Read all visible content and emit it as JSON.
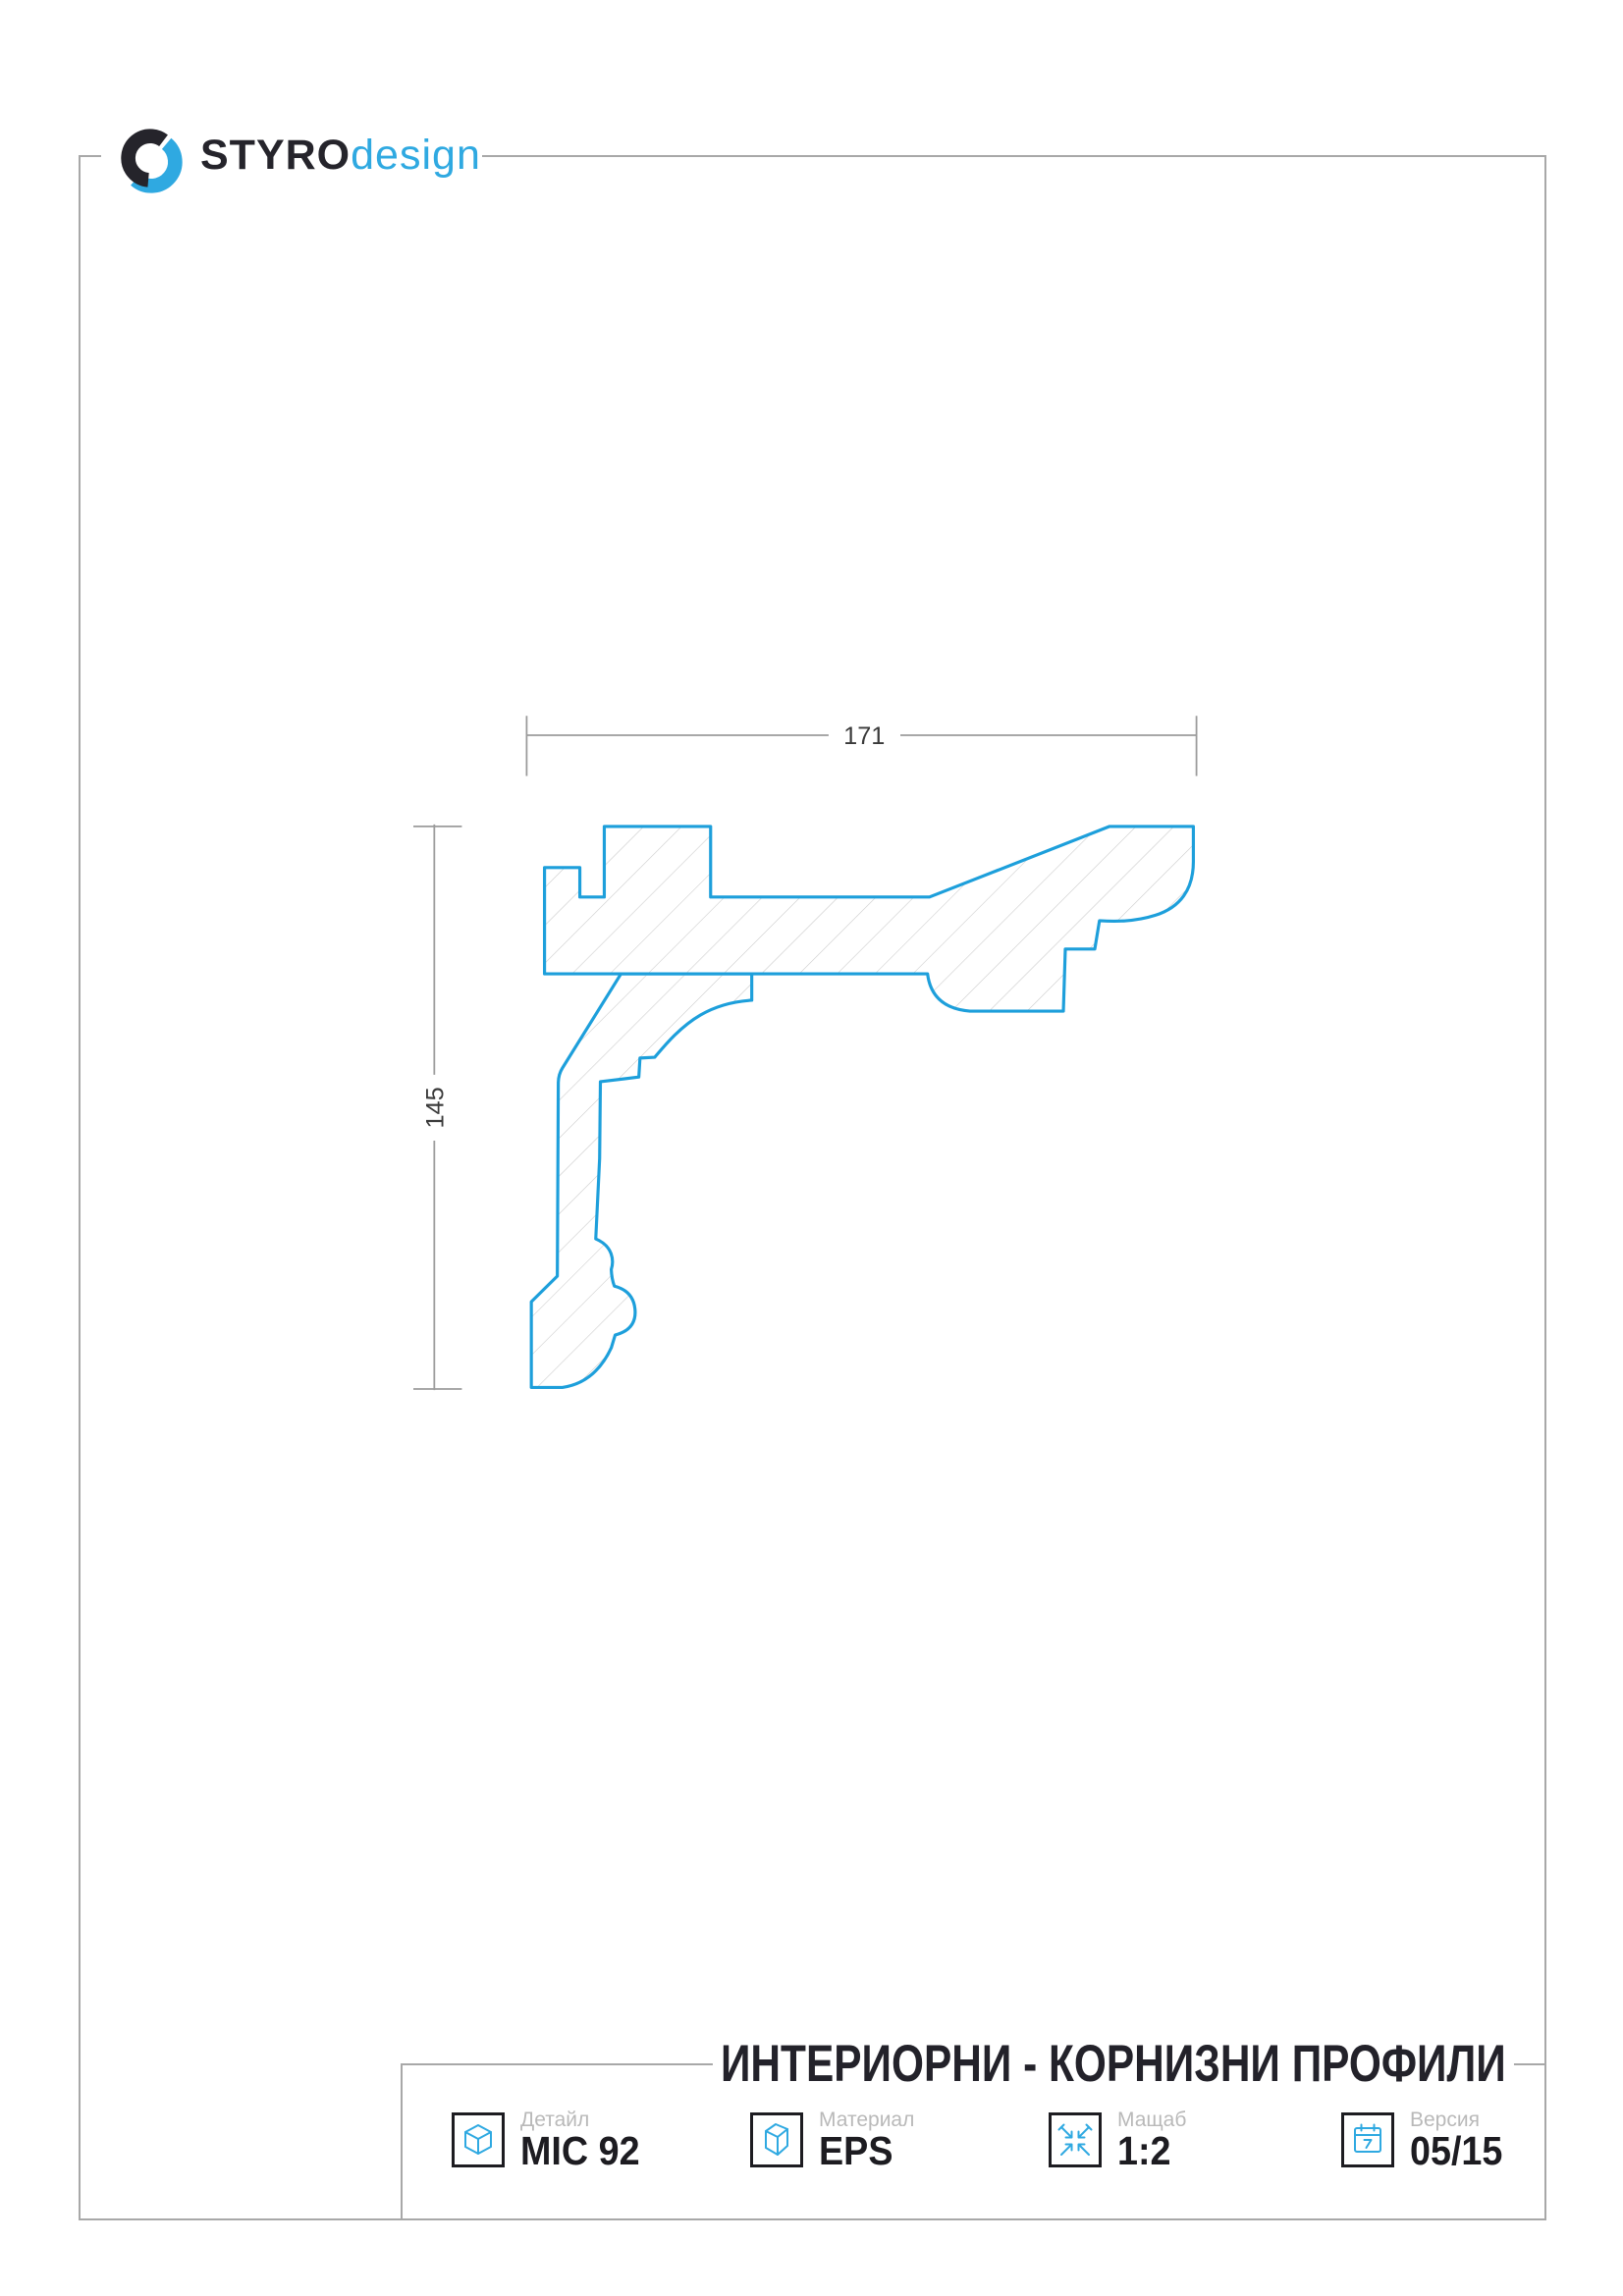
{
  "logo": {
    "brand": "STYRO",
    "brand_suffix": "design"
  },
  "drawing": {
    "width_label": "171",
    "height_label": "145"
  },
  "title_block": {
    "title": "ИНТЕРИОРНИ - КОРНИЗНИ ПРОФИЛИ",
    "cells": [
      {
        "label": "Детайл",
        "value": "MIC 92",
        "icon": "cube-icon"
      },
      {
        "label": "Материал",
        "value": "EPS",
        "icon": "material-box-icon"
      },
      {
        "label": "Мащаб",
        "value": "1:2",
        "icon": "scale-arrows-icon"
      },
      {
        "label": "Версия",
        "value": "05/15",
        "icon": "calendar-icon"
      }
    ]
  },
  "colors": {
    "outline_blue": "#1d9fdb",
    "logo_blue": "#2fa9e1",
    "logo_dark": "#25242b",
    "frame_gray": "#a8a8a8",
    "dim_gray": "#9b9b9b",
    "hatch_gray": "#c9c9c9",
    "text_dark": "#1d1c21",
    "label_gray": "#b9b9b9"
  }
}
